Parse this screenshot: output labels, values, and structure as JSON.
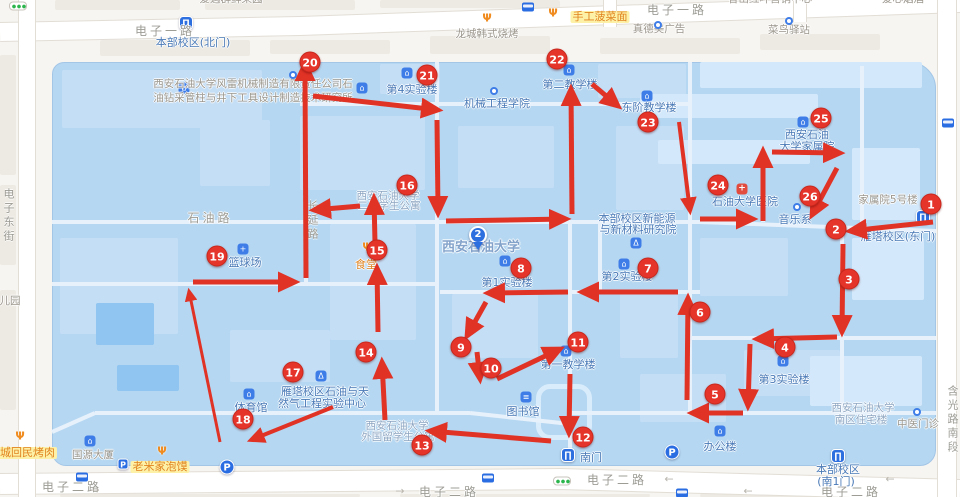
{
  "map": {
    "arrow_color": "#e13226",
    "campus_fill": "#b5d7f1",
    "marker_color": "#e5352b",
    "pin": {
      "n": "2"
    },
    "markers": [
      {
        "n": "1",
        "x": 931,
        "y": 204
      },
      {
        "n": "2",
        "x": 836,
        "y": 229
      },
      {
        "n": "3",
        "x": 849,
        "y": 279
      },
      {
        "n": "4",
        "x": 785,
        "y": 347
      },
      {
        "n": "5",
        "x": 715,
        "y": 394
      },
      {
        "n": "6",
        "x": 700,
        "y": 312
      },
      {
        "n": "7",
        "x": 648,
        "y": 268
      },
      {
        "n": "8",
        "x": 521,
        "y": 268
      },
      {
        "n": "9",
        "x": 461,
        "y": 347
      },
      {
        "n": "10",
        "x": 491,
        "y": 368
      },
      {
        "n": "11",
        "x": 578,
        "y": 342
      },
      {
        "n": "12",
        "x": 583,
        "y": 437
      },
      {
        "n": "13",
        "x": 422,
        "y": 445
      },
      {
        "n": "14",
        "x": 366,
        "y": 352
      },
      {
        "n": "15",
        "x": 377,
        "y": 250
      },
      {
        "n": "16",
        "x": 407,
        "y": 185
      },
      {
        "n": "17",
        "x": 293,
        "y": 372
      },
      {
        "n": "18",
        "x": 243,
        "y": 419
      },
      {
        "n": "19",
        "x": 217,
        "y": 256
      },
      {
        "n": "20",
        "x": 310,
        "y": 62
      },
      {
        "n": "21",
        "x": 427,
        "y": 75
      },
      {
        "n": "22",
        "x": 557,
        "y": 59
      },
      {
        "n": "23",
        "x": 648,
        "y": 122
      },
      {
        "n": "24",
        "x": 718,
        "y": 185
      },
      {
        "n": "25",
        "x": 821,
        "y": 118
      },
      {
        "n": "26",
        "x": 810,
        "y": 196
      }
    ],
    "route_arrows": [
      [
        933,
        222,
        850,
        231
      ],
      [
        843,
        244,
        842,
        332
      ],
      [
        837,
        337,
        757,
        339
      ],
      [
        750,
        344,
        748,
        406
      ],
      [
        743,
        413,
        692,
        413
      ],
      [
        687,
        400,
        688,
        298
      ],
      [
        678,
        292,
        582,
        292
      ],
      [
        568,
        292,
        488,
        293
      ],
      [
        486,
        302,
        467,
        336
      ],
      [
        477,
        352,
        480,
        379
      ],
      [
        497,
        379,
        560,
        349
      ],
      [
        570,
        374,
        569,
        433
      ],
      [
        551,
        441,
        430,
        431
      ],
      [
        333,
        407,
        251,
        440,
        4
      ],
      [
        385,
        420,
        382,
        362
      ],
      [
        378,
        332,
        377,
        268
      ],
      [
        375,
        243,
        374,
        198
      ],
      [
        360,
        206,
        314,
        210
      ],
      [
        220,
        442,
        189,
        291,
        3
      ],
      [
        193,
        282,
        295,
        282
      ],
      [
        306,
        278,
        305,
        64
      ],
      [
        313,
        96,
        438,
        110
      ],
      [
        437,
        120,
        438,
        213
      ],
      [
        446,
        221,
        566,
        219
      ],
      [
        700,
        219,
        753,
        219
      ],
      [
        763,
        221,
        763,
        151
      ],
      [
        772,
        152,
        840,
        153
      ],
      [
        837,
        168,
        812,
        215
      ],
      [
        572,
        214,
        571,
        89
      ],
      [
        592,
        84,
        618,
        106
      ],
      [
        679,
        122,
        690,
        211,
        4
      ]
    ],
    "poi_labels": [
      {
        "t": "电子一路",
        "x": 165,
        "y": 25,
        "c": "r"
      },
      {
        "t": "电子一路",
        "x": 677,
        "y": 4,
        "c": "r"
      },
      {
        "t": "电子二路",
        "x": 72,
        "y": 481,
        "c": "r"
      },
      {
        "t": "电子二路",
        "x": 449,
        "y": 486,
        "c": "r"
      },
      {
        "t": "电子二路",
        "x": 617,
        "y": 474,
        "c": "r"
      },
      {
        "t": "电子二路",
        "x": 851,
        "y": 486,
        "c": "r"
      },
      {
        "t": "石油路",
        "x": 210,
        "y": 212,
        "c": "r"
      },
      {
        "t": "家属院5号楼",
        "x": 888,
        "y": 195,
        "c": "g"
      },
      {
        "t": "儿园",
        "x": 10,
        "y": 296,
        "c": "g"
      },
      {
        "t": "爱遇群鲜果园",
        "x": 231,
        "y": -6,
        "c": "g"
      },
      {
        "t": "香山红叶营销中心",
        "x": 770,
        "y": -6,
        "c": "g"
      },
      {
        "t": "爱心烟酒",
        "x": 903,
        "y": -6,
        "c": "g"
      },
      {
        "t": "真德美广告",
        "x": 659,
        "y": 24,
        "c": "g"
      },
      {
        "t": "菜鸟驿站",
        "x": 789,
        "y": 25,
        "c": "g"
      },
      {
        "t": "龙城韩式烧烤",
        "x": 487,
        "y": 29,
        "c": "g"
      },
      {
        "t": "国源大厦",
        "x": 93,
        "y": 450,
        "c": "g"
      },
      {
        "t": "中医门诊",
        "x": 918,
        "y": 419,
        "c": "g"
      },
      {
        "t": "西安石油大学风雷机械制造有限责任公司石",
        "x": 253,
        "y": 79,
        "c": "g"
      },
      {
        "t": "油钻采管柱与井下工具设计制造技术研究所",
        "x": 253,
        "y": 93,
        "c": "g"
      },
      {
        "t": "西安石油大学",
        "x": 388,
        "y": 191,
        "c": "d"
      },
      {
        "t": "二号学生公寓",
        "x": 389,
        "y": 201,
        "c": "d"
      },
      {
        "t": "西安石油大学",
        "x": 397,
        "y": 421,
        "c": "d"
      },
      {
        "t": "外国留学生公寓",
        "x": 398,
        "y": 432,
        "c": "d"
      },
      {
        "t": "西安石油大学",
        "x": 863,
        "y": 403,
        "c": "d"
      },
      {
        "t": "南区住宅楼",
        "x": 861,
        "y": 415,
        "c": "d"
      },
      {
        "t": "本部校区(北门)",
        "x": 193,
        "y": 37,
        "c": "b"
      },
      {
        "t": "第4实验楼",
        "x": 412,
        "y": 84,
        "c": "b"
      },
      {
        "t": "机械工程学院",
        "x": 497,
        "y": 98,
        "c": "b"
      },
      {
        "t": "第二教学楼",
        "x": 570,
        "y": 79,
        "c": "b"
      },
      {
        "t": "东阶教学楼",
        "x": 649,
        "y": 102,
        "c": "b"
      },
      {
        "t": "西安石油",
        "x": 807,
        "y": 129,
        "c": "b"
      },
      {
        "t": "大学家属院",
        "x": 807,
        "y": 141,
        "c": "b"
      },
      {
        "t": "石油大学医院",
        "x": 745,
        "y": 196,
        "c": "b"
      },
      {
        "t": "音乐系",
        "x": 795,
        "y": 214,
        "c": "b"
      },
      {
        "t": "本部校区新能源",
        "x": 637,
        "y": 213,
        "c": "b"
      },
      {
        "t": "与新材料研究院",
        "x": 638,
        "y": 224,
        "c": "b"
      },
      {
        "t": "第2实验楼",
        "x": 627,
        "y": 271,
        "c": "b"
      },
      {
        "t": "第1实验楼",
        "x": 507,
        "y": 277,
        "c": "b"
      },
      {
        "t": "第3实验楼",
        "x": 784,
        "y": 374,
        "c": "b"
      },
      {
        "t": "办公楼",
        "x": 720,
        "y": 441,
        "c": "b"
      },
      {
        "t": "第一教学楼",
        "x": 568,
        "y": 359,
        "c": "b"
      },
      {
        "t": "图书馆",
        "x": 523,
        "y": 406,
        "c": "b"
      },
      {
        "t": "篮球场",
        "x": 245,
        "y": 257,
        "c": "b"
      },
      {
        "t": "体育馆",
        "x": 251,
        "y": 402,
        "c": "b"
      },
      {
        "t": "雁塔校区石油与天",
        "x": 325,
        "y": 386,
        "c": "b"
      },
      {
        "t": "然气工程实验中心",
        "x": 322,
        "y": 398,
        "c": "b"
      },
      {
        "t": "南门",
        "x": 591,
        "y": 452,
        "c": "b"
      },
      {
        "t": "雁塔校区(东门)",
        "x": 898,
        "y": 231,
        "c": "b"
      },
      {
        "t": "本部校区",
        "x": 838,
        "y": 464,
        "c": "b"
      },
      {
        "t": "(南1门)",
        "x": 836,
        "y": 476,
        "c": "b"
      },
      {
        "t": "食堂",
        "x": 366,
        "y": 259,
        "c": "o"
      },
      {
        "t": "老米家泡馍",
        "x": 160,
        "y": 461,
        "c": "o",
        "bg": 1
      },
      {
        "t": "手工菠菜面",
        "x": 600,
        "y": 11,
        "c": "o",
        "bg": 1
      },
      {
        "t": "老城回民烤肉",
        "x": 22,
        "y": 447,
        "c": "o",
        "bg": 1
      },
      {
        "t": "西安石油大学",
        "x": 481,
        "y": 241,
        "c": "n"
      }
    ],
    "v_labels": [
      {
        "t": "长延路",
        "x": 304,
        "y": 200
      },
      {
        "t": "电子东街",
        "x": 0,
        "y": 188
      },
      {
        "t": "含光路南段",
        "x": 944,
        "y": 385
      }
    ],
    "icon_glyphs": {
      "gate": "∏",
      "bld": "⌂",
      "lab": "Δ",
      "hosp": "+",
      "book": "≡",
      "dot": "",
      "sport": "+",
      "food": "Ψ",
      "p": "P"
    },
    "icons": [
      {
        "k": "gate",
        "x": 186,
        "y": 23,
        "name": "north-gate-icon"
      },
      {
        "k": "gate",
        "x": 923,
        "y": 217,
        "name": "east-gate-icon"
      },
      {
        "k": "gate",
        "x": 568,
        "y": 455,
        "name": "south-gate-icon"
      },
      {
        "k": "gate",
        "x": 838,
        "y": 456,
        "name": "south1-gate-icon"
      },
      {
        "k": "bld",
        "x": 184,
        "y": 88,
        "name": "company-building-icon"
      },
      {
        "k": "bld",
        "x": 362,
        "y": 88,
        "name": "institute-building-icon"
      },
      {
        "k": "bld",
        "x": 407,
        "y": 73,
        "name": "lab4-building-icon"
      },
      {
        "k": "bld",
        "x": 569,
        "y": 70,
        "name": "teaching2-building-icon"
      },
      {
        "k": "bld",
        "x": 647,
        "y": 96,
        "name": "east-teaching-building-icon"
      },
      {
        "k": "bld",
        "x": 803,
        "y": 122,
        "name": "family-compound-building-icon"
      },
      {
        "k": "bld",
        "x": 624,
        "y": 264,
        "name": "lab2-building-icon"
      },
      {
        "k": "bld",
        "x": 505,
        "y": 261,
        "name": "lab1-building-icon"
      },
      {
        "k": "bld",
        "x": 783,
        "y": 361,
        "name": "lab3-building-icon"
      },
      {
        "k": "bld",
        "x": 720,
        "y": 431,
        "name": "office-building-icon"
      },
      {
        "k": "bld",
        "x": 566,
        "y": 351,
        "name": "teaching1-building-icon"
      },
      {
        "k": "bld",
        "x": 90,
        "y": 441,
        "name": "guoyuan-building-icon"
      },
      {
        "k": "bld",
        "x": 249,
        "y": 394,
        "name": "gym-icon"
      },
      {
        "k": "lab",
        "x": 636,
        "y": 243,
        "name": "new-energy-lab-icon"
      },
      {
        "k": "lab",
        "x": 321,
        "y": 376,
        "name": "petro-gas-lab-icon"
      },
      {
        "k": "hosp",
        "x": 742,
        "y": 189,
        "name": "hospital-icon"
      },
      {
        "k": "book",
        "x": 526,
        "y": 397,
        "name": "library-icon"
      },
      {
        "k": "dot",
        "x": 494,
        "y": 91,
        "name": "mech-college-dot-icon"
      },
      {
        "k": "dot",
        "x": 797,
        "y": 207,
        "name": "music-dept-dot-icon"
      },
      {
        "k": "dot",
        "x": 917,
        "y": 412,
        "name": "clinic-dot-icon"
      },
      {
        "k": "sport",
        "x": 243,
        "y": 249,
        "name": "basketball-court-icon"
      },
      {
        "k": "food",
        "x": 367,
        "y": 247,
        "name": "canteen-icon"
      },
      {
        "k": "food",
        "x": 553,
        "y": 13,
        "name": "noodle-restaurant-icon"
      },
      {
        "k": "food",
        "x": 487,
        "y": 18,
        "name": "bbq-restaurant-icon"
      },
      {
        "k": "food",
        "x": 162,
        "y": 451,
        "name": "paomo-restaurant-icon"
      },
      {
        "k": "food",
        "x": 20,
        "y": 436,
        "name": "kaorou-restaurant-icon"
      }
    ],
    "p_icons": [
      {
        "x": 123,
        "y": 464,
        "small": 1
      },
      {
        "x": 227,
        "y": 467
      },
      {
        "x": 672,
        "y": 452
      }
    ],
    "bus_icons": [
      [
        528,
        7
      ],
      [
        948,
        123
      ],
      [
        82,
        477
      ],
      [
        488,
        478
      ],
      [
        682,
        493
      ]
    ],
    "traffic_lights": [
      [
        18,
        6
      ],
      [
        562,
        481
      ]
    ],
    "stop_dots": [
      [
        293,
        75
      ],
      [
        658,
        25
      ],
      [
        789,
        21
      ]
    ],
    "road_arrows": [
      {
        "t": "←",
        "x": 669,
        "y": 479
      },
      {
        "t": "←",
        "x": 890,
        "y": 479
      },
      {
        "t": "→",
        "x": 95,
        "y": 490
      },
      {
        "t": "→",
        "x": 400,
        "y": 491
      },
      {
        "t": "←",
        "x": 748,
        "y": 491
      }
    ],
    "outer_roads": [
      {
        "pts": [
          [
            0,
            32
          ],
          [
            300,
            26
          ],
          [
            960,
            3
          ]
        ],
        "w": 18
      },
      {
        "pts": [
          [
            0,
            484
          ],
          [
            560,
            479
          ],
          [
            960,
            490
          ]
        ],
        "w": 20
      },
      {
        "pts": [
          [
            27,
            0
          ],
          [
            27,
            497
          ]
        ],
        "w": 16
      },
      {
        "pts": [
          [
            947,
            0
          ],
          [
            947,
            497
          ]
        ],
        "w": 18
      },
      {
        "pts": [
          [
            610,
            0
          ],
          [
            610,
            27
          ]
        ],
        "w": 12
      },
      {
        "pts": [
          [
            800,
            0
          ],
          [
            800,
            22
          ]
        ],
        "w": 12
      }
    ],
    "inner_roads": [
      [
        52,
        222,
        700,
        222
      ],
      [
        700,
        222,
        936,
        231
      ],
      [
        52,
        284,
        437,
        284
      ],
      [
        440,
        292,
        700,
        292
      ],
      [
        690,
        338,
        936,
        338
      ],
      [
        570,
        413,
        936,
        413
      ],
      [
        95,
        413,
        470,
        413
      ],
      [
        52,
        432,
        95,
        413
      ],
      [
        470,
        413,
        570,
        424
      ],
      [
        300,
        104,
        690,
        104
      ],
      [
        306,
        62,
        306,
        284
      ],
      [
        437,
        62,
        437,
        412
      ],
      [
        570,
        222,
        570,
        458
      ],
      [
        690,
        62,
        690,
        413
      ],
      [
        763,
        150,
        763,
        222
      ],
      [
        842,
        222,
        842,
        413
      ],
      [
        600,
        222,
        600,
        292
      ],
      [
        862,
        66,
        862,
        222
      ]
    ],
    "campus_blocks": [
      [
        62,
        70,
        200,
        58,
        0
      ],
      [
        300,
        116,
        125,
        74,
        0
      ],
      [
        458,
        126,
        96,
        62,
        0
      ],
      [
        598,
        64,
        88,
        34,
        0
      ],
      [
        616,
        126,
        68,
        84,
        0
      ],
      [
        700,
        62,
        222,
        26,
        1
      ],
      [
        640,
        94,
        178,
        24,
        1
      ],
      [
        658,
        140,
        152,
        24,
        1
      ],
      [
        852,
        148,
        68,
        72,
        1
      ],
      [
        60,
        238,
        118,
        96,
        0
      ],
      [
        96,
        303,
        58,
        42,
        2
      ],
      [
        117,
        365,
        62,
        26,
        2
      ],
      [
        330,
        224,
        86,
        116,
        0
      ],
      [
        452,
        294,
        86,
        64,
        0
      ],
      [
        620,
        294,
        58,
        64,
        0
      ],
      [
        700,
        238,
        88,
        58,
        0
      ],
      [
        744,
        350,
        96,
        46,
        0
      ],
      [
        640,
        374,
        86,
        48,
        0
      ],
      [
        810,
        356,
        112,
        50,
        1
      ],
      [
        852,
        238,
        72,
        62,
        1
      ],
      [
        380,
        64,
        60,
        30,
        0
      ],
      [
        200,
        120,
        70,
        66,
        0
      ],
      [
        230,
        330,
        100,
        52,
        0
      ]
    ],
    "outside_blocks": [
      [
        55,
        0,
        125,
        10
      ],
      [
        205,
        0,
        150,
        10
      ],
      [
        380,
        0,
        180,
        8
      ],
      [
        845,
        0,
        90,
        10
      ],
      [
        0,
        55,
        16,
        120
      ],
      [
        0,
        185,
        16,
        80
      ],
      [
        0,
        290,
        16,
        120
      ],
      [
        100,
        40,
        150,
        16
      ],
      [
        270,
        40,
        120,
        14
      ],
      [
        430,
        36,
        120,
        18
      ],
      [
        600,
        38,
        140,
        16
      ],
      [
        760,
        34,
        120,
        16
      ],
      [
        60,
        494,
        300,
        3
      ],
      [
        400,
        494,
        250,
        3
      ],
      [
        700,
        494,
        200,
        3
      ]
    ],
    "plaza": [
      536,
      384,
      56,
      56
    ]
  }
}
